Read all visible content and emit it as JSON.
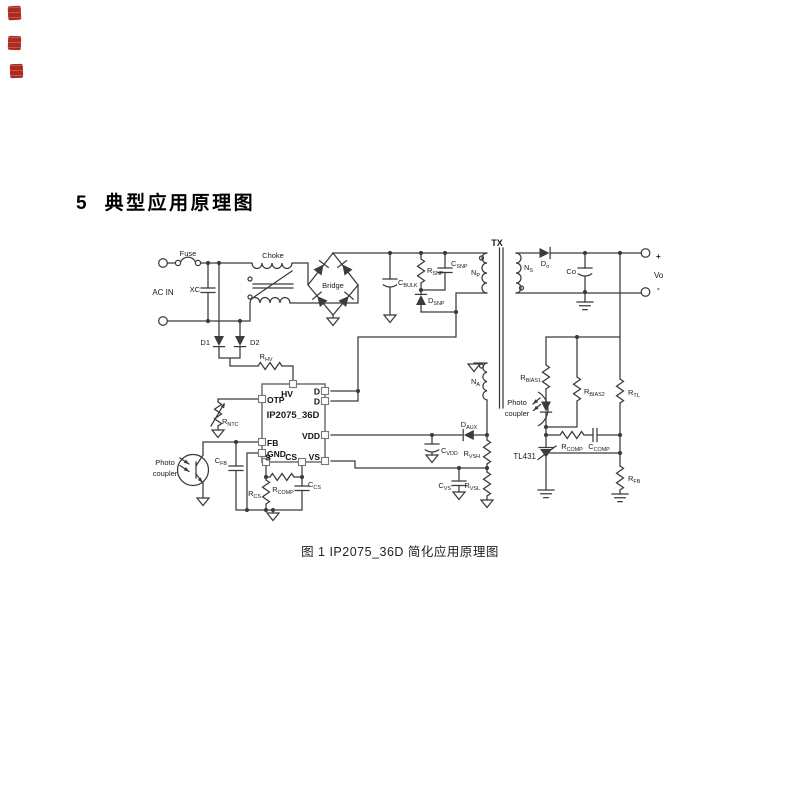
{
  "stamp": {
    "color": "#a5170e"
  },
  "heading": {
    "number": "5",
    "title": "典型应用原理图"
  },
  "caption": "图 1  IP2075_36D 简化应用原理图",
  "ic": {
    "name": "IP2075_36D",
    "pins": {
      "hv": "HV",
      "otp": "OTP",
      "fb": "FB",
      "gnd": "GND",
      "s": "S",
      "cs": "CS",
      "vs": "VS",
      "vdd": "VDD",
      "d1": "D",
      "d2": "D"
    }
  },
  "labels": {
    "fuse": "Fuse",
    "ac_in": "AC IN",
    "xc": "XC",
    "choke": "Choke",
    "bridge": "Bridge",
    "d1": "D1",
    "d2": "D2",
    "r_hv": {
      "m": "R",
      "s": "HV"
    },
    "c_bulk": {
      "m": "C",
      "s": "BULK"
    },
    "r_snp": {
      "m": "R",
      "s": "SNP"
    },
    "c_snp": {
      "m": "C",
      "s": "SNP"
    },
    "d_snp": {
      "m": "D",
      "s": "SNP"
    },
    "tx": "TX",
    "n_p": {
      "m": "N",
      "s": "P"
    },
    "n_s": {
      "m": "N",
      "s": "S"
    },
    "n_a": {
      "m": "N",
      "s": "A"
    },
    "d_o": {
      "m": "D",
      "s": "o"
    },
    "co": "Co",
    "plus": "+",
    "vo": "Vo",
    "minus": "-",
    "r_ntc": {
      "m": "R",
      "s": "NTC"
    },
    "photo_line1": "Photo",
    "photo_line2": "coupler",
    "c_fb": {
      "m": "C",
      "s": "FB"
    },
    "r_cs": {
      "m": "R",
      "s": "CS"
    },
    "r_comp": {
      "m": "R",
      "s": "COMP"
    },
    "c_cs": {
      "m": "C",
      "s": "CS"
    },
    "d_aux": {
      "m": "D",
      "s": "AUX"
    },
    "c_vdd": {
      "m": "C",
      "s": "VDD"
    },
    "r_vsh": {
      "m": "R",
      "s": "VSH"
    },
    "r_vsl": {
      "m": "R",
      "s": "VSL"
    },
    "c_vs": {
      "m": "C",
      "s": "VS"
    },
    "r_bias1": {
      "m": "R",
      "s": "BIAS1"
    },
    "r_bias2": {
      "m": "R",
      "s": "BIAS2"
    },
    "r_tl": {
      "m": "R",
      "s": "TL"
    },
    "r_comp2": {
      "m": "R",
      "s": "COMP"
    },
    "c_comp": {
      "m": "C",
      "s": "COMP"
    },
    "tl431": "TL431",
    "r_fb": {
      "m": "R",
      "s": "FB"
    }
  }
}
